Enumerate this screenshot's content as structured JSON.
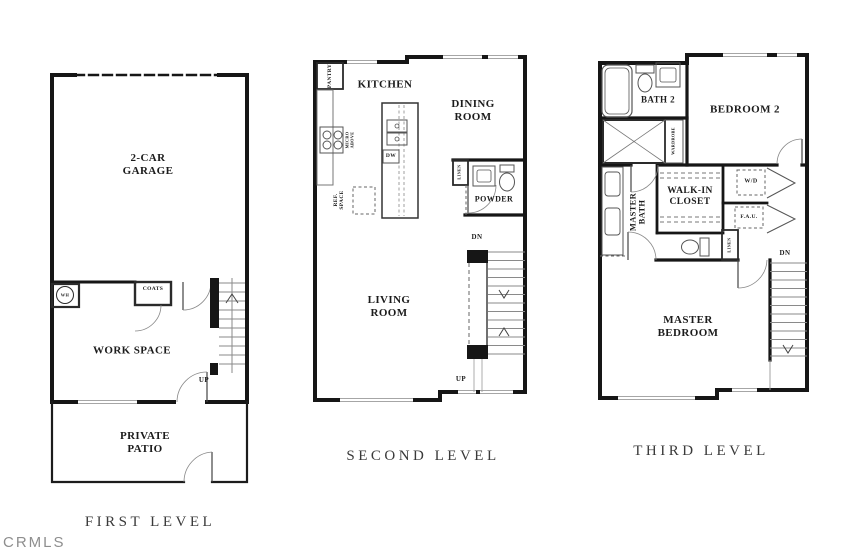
{
  "watermark": "CRMLS",
  "first": {
    "title": "FIRST LEVEL",
    "garage": "2-CAR\nGARAGE",
    "work_space": "WORK SPACE",
    "private_patio": "PRIVATE\nPATIO",
    "coats": "COATS",
    "wh": "WH",
    "up": "UP"
  },
  "second": {
    "title": "SECOND LEVEL",
    "kitchen": "KITCHEN",
    "dining_room": "DINING\nROOM",
    "living_room": "LIVING\nROOM",
    "powder": "POWDER",
    "pantry": "PANTRY",
    "ref_space": "REF.\nSPACE",
    "micro_above": "MICRO\nABOVE",
    "dw": "DW",
    "linen": "LINEN",
    "dn": "DN",
    "up": "UP"
  },
  "third": {
    "title": "THIRD LEVEL",
    "bath_2": "BATH 2",
    "bedroom_2": "BEDROOM 2",
    "wardrobe": "WARDROBE",
    "master_bath": "MASTER\nBATH",
    "walk_in_closet": "WALK-IN\nCLOSET",
    "wd": "W/D",
    "fau": "F.A.U.",
    "linen": "LINEN",
    "master_bedroom": "MASTER\nBEDROOM",
    "dn": "DN"
  }
}
